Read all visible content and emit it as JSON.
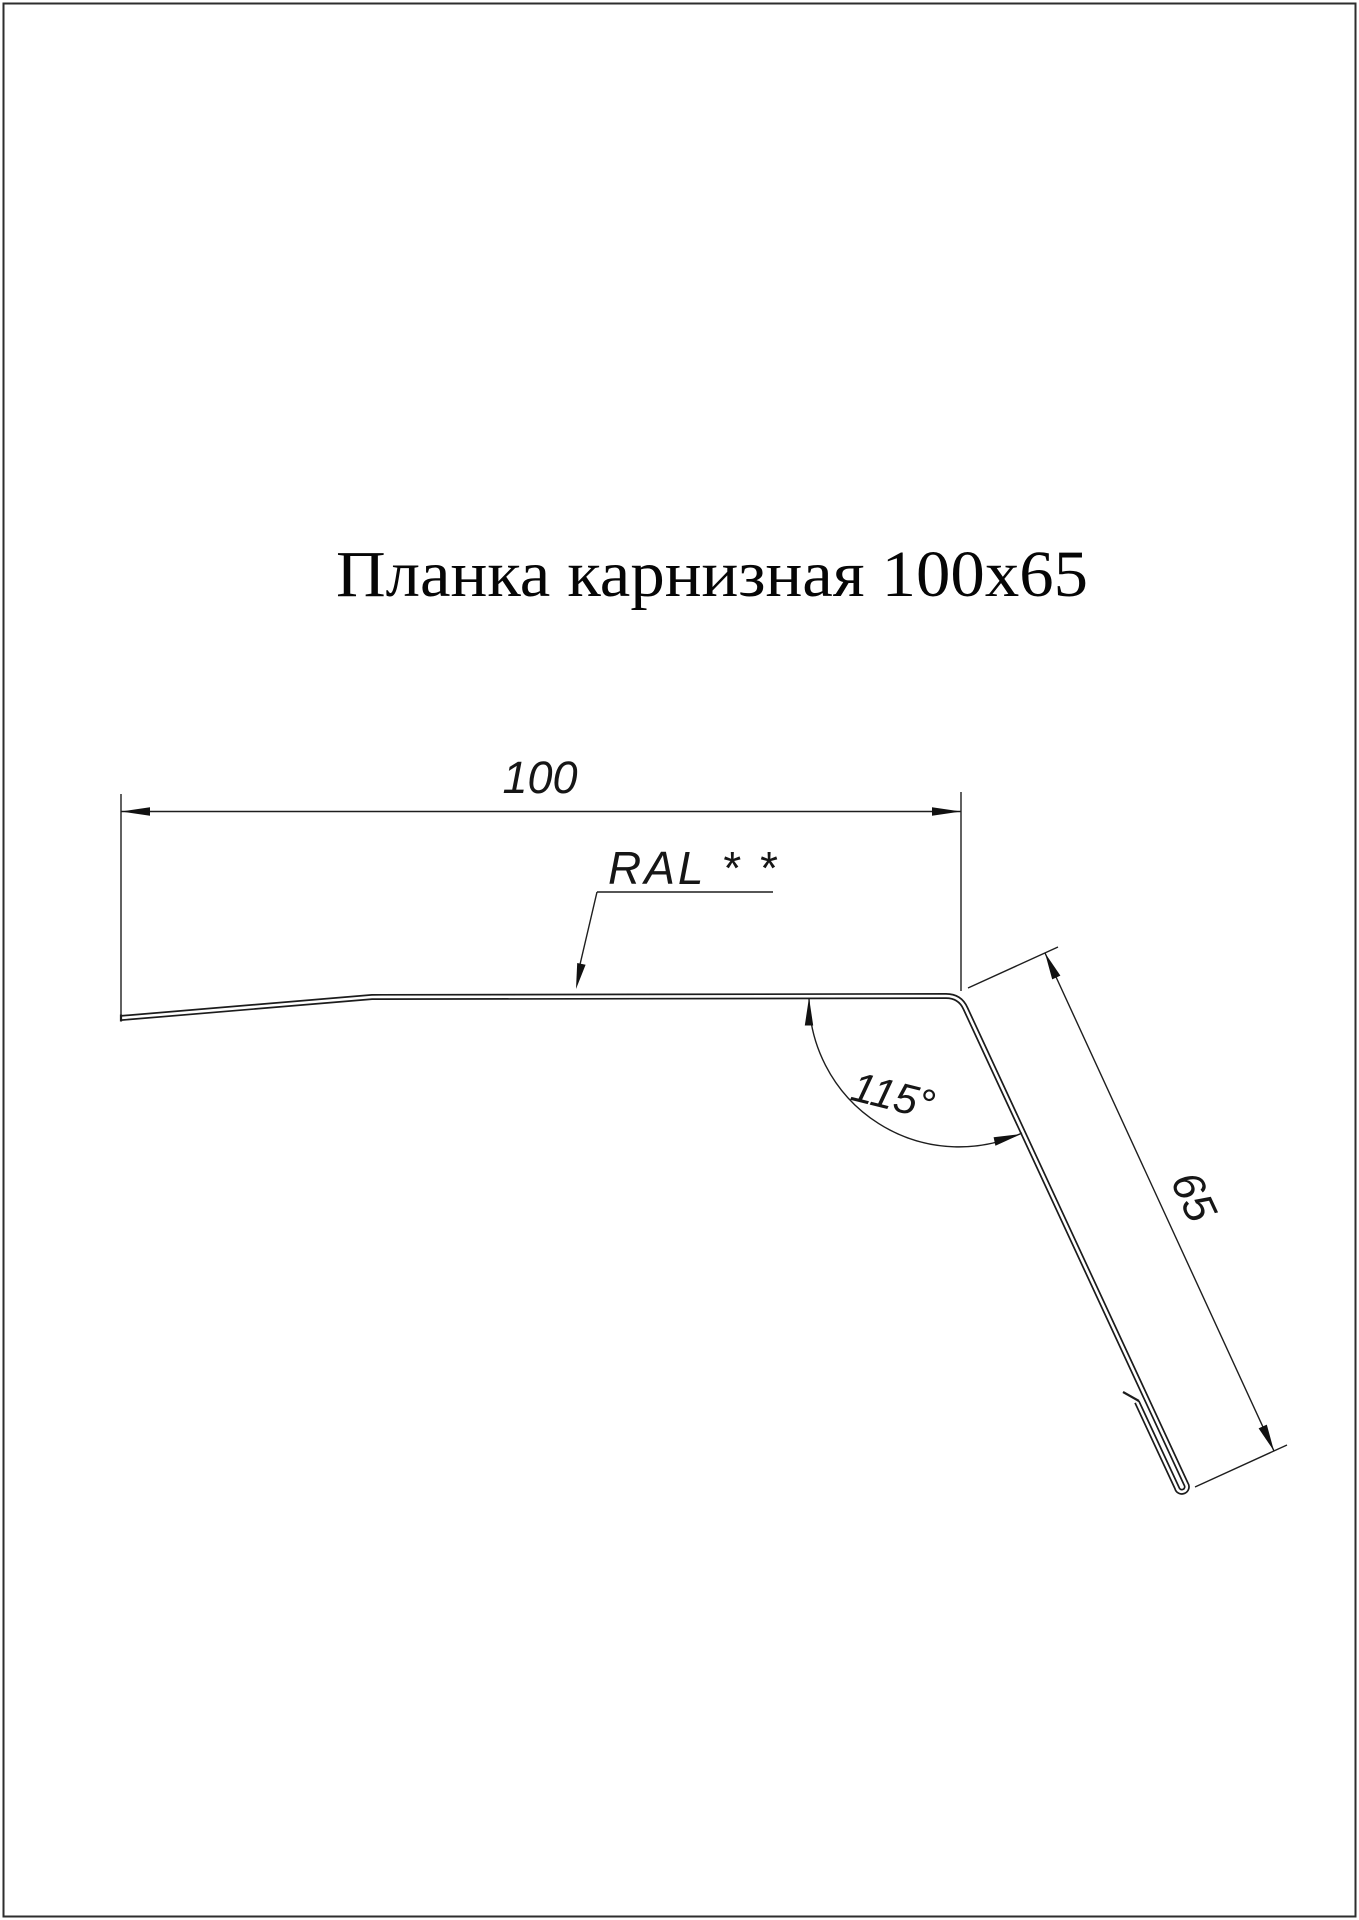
{
  "page": {
    "title": "Планка карнизная 100x65",
    "background_color": "#ffffff",
    "border_color": "#2e2e2e",
    "line_color": "#1c1c1c"
  },
  "annotations": {
    "width_label": "100",
    "flange_label": "65",
    "angle_label": "115°",
    "coating_label": "RAL * *"
  },
  "part": {
    "type": "eaves-strip-profile-drawing",
    "width_mm": 100,
    "flange_length_mm": 65,
    "bend_angle_deg": 115
  }
}
